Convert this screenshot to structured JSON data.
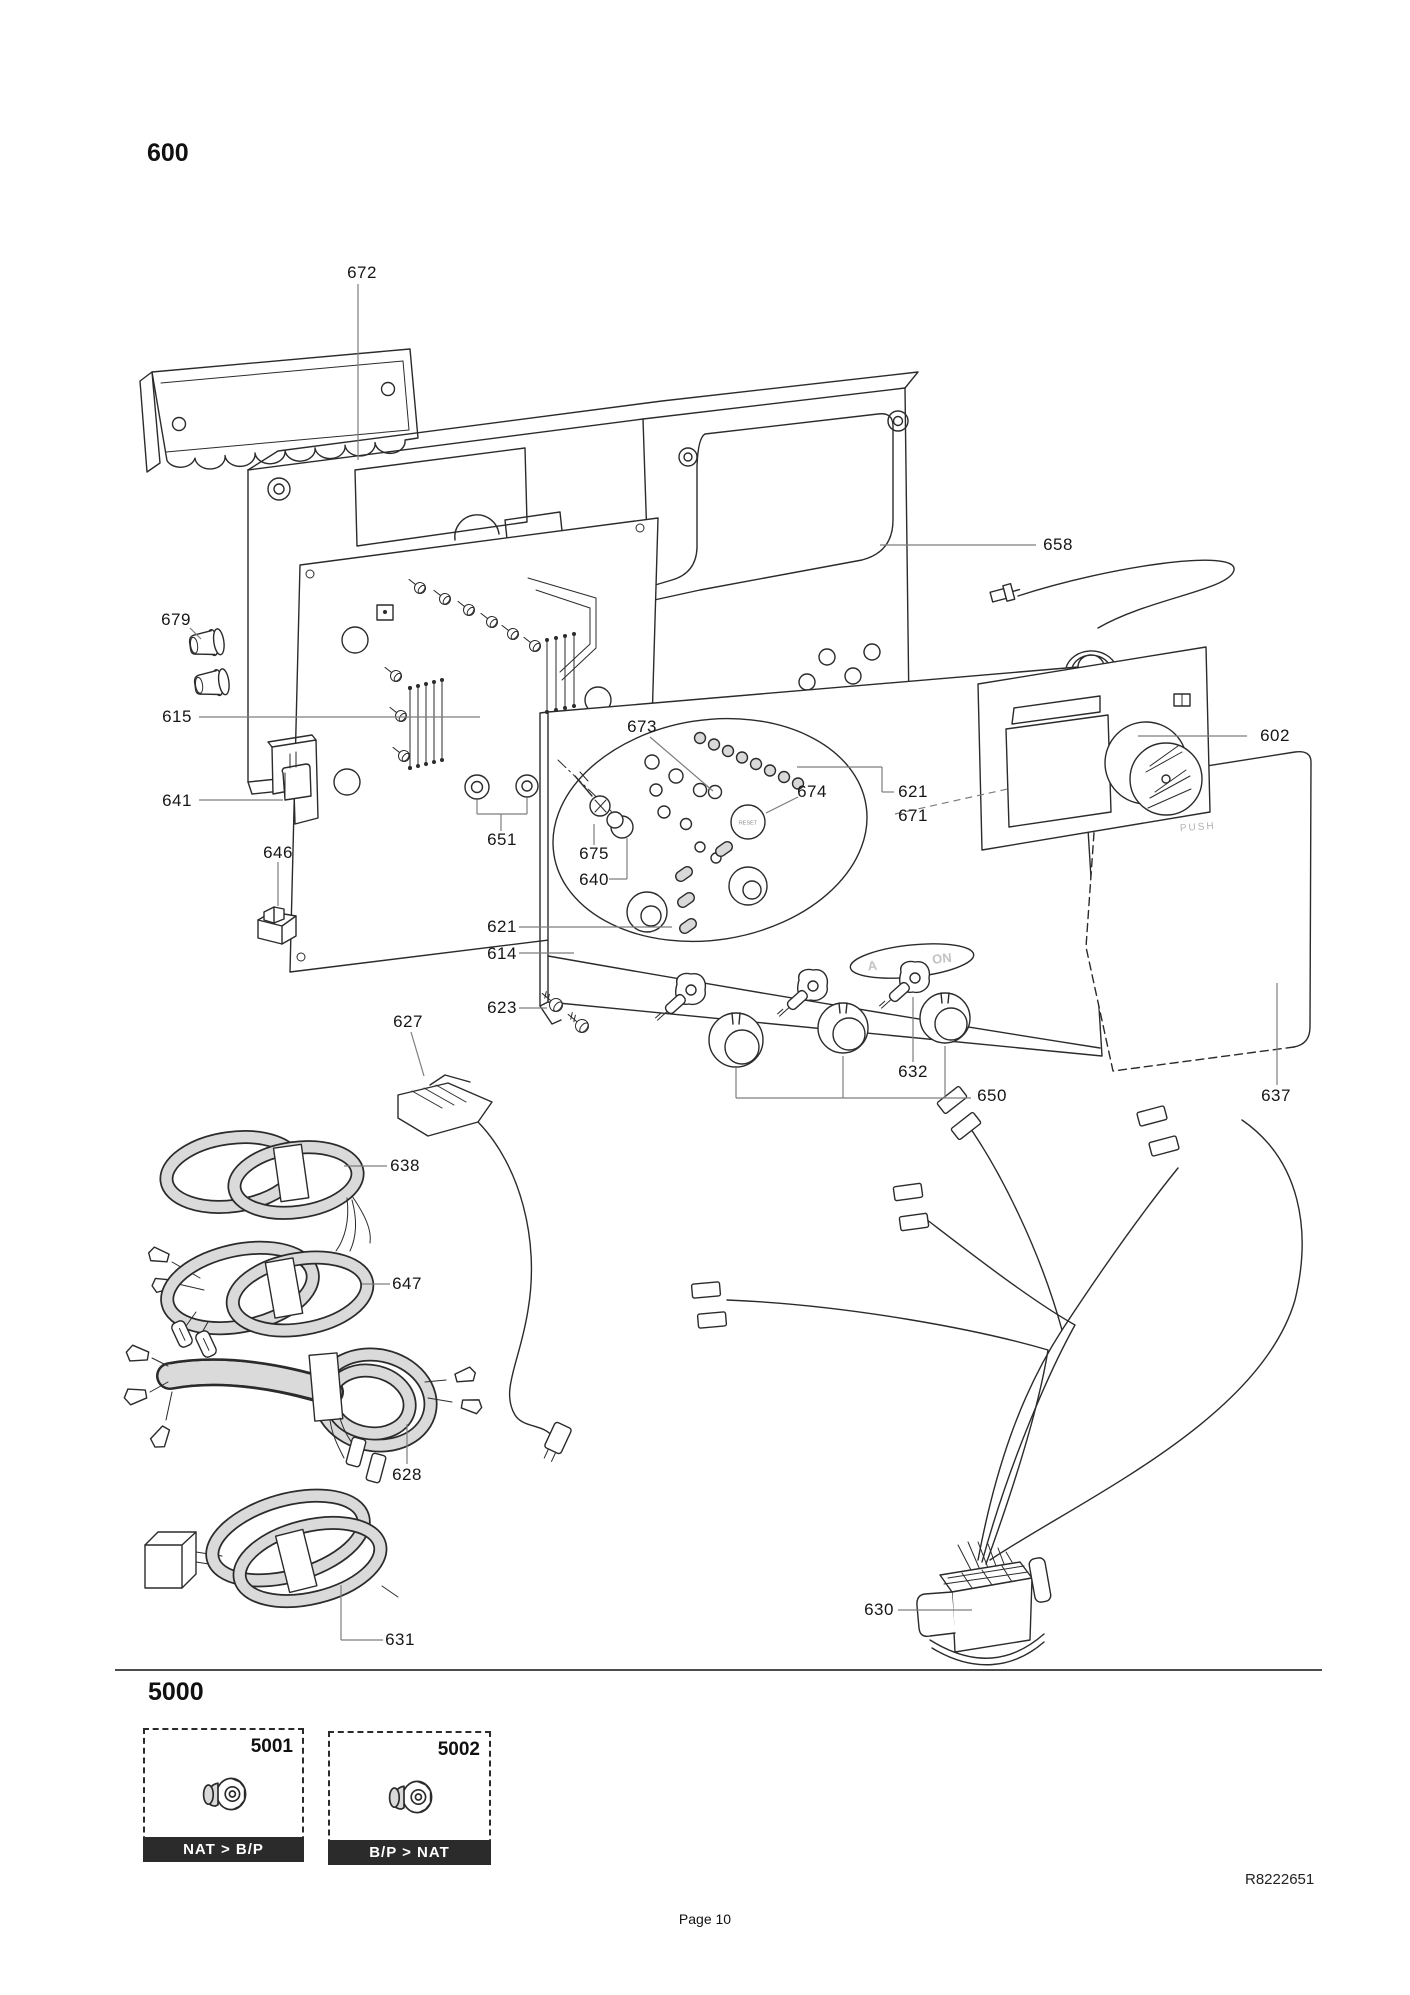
{
  "page": {
    "section1_title": "600",
    "section2_title": "5000",
    "doc_ref": "R8222651",
    "footer": "Page 10"
  },
  "panel": {
    "push_label": "PUSH",
    "reset_label": "RESET",
    "badge_left": "A",
    "badge_right": "ON"
  },
  "kits": [
    {
      "number": "5001",
      "conversion": "NAT > B/P"
    },
    {
      "number": "5002",
      "conversion": "B/P > NAT"
    }
  ],
  "colors": {
    "line": "#2b2b2b",
    "leader": "#7d7d7d",
    "cable_fill": "#dadada",
    "kit_bar_bg": "#2b2b2b",
    "kit_bar_text": "#ffffff"
  },
  "part_labels": [
    {
      "t": "672",
      "x": 362,
      "y": 273,
      "lead": [
        [
          358,
          284,
          358,
          460
        ]
      ]
    },
    {
      "t": "658",
      "x": 1058,
      "y": 545,
      "lead": [
        [
          880,
          545,
          1036,
          545
        ]
      ]
    },
    {
      "t": "679",
      "x": 176,
      "y": 620,
      "lead": [
        [
          190,
          628,
          201,
          639
        ]
      ]
    },
    {
      "t": "615",
      "x": 177,
      "y": 717,
      "lead": [
        [
          199,
          717,
          480,
          717
        ]
      ]
    },
    {
      "t": "602",
      "x": 1275,
      "y": 736,
      "lead": [
        [
          1138,
          736,
          1247,
          736
        ]
      ]
    },
    {
      "t": "673",
      "x": 642,
      "y": 727,
      "lead": [
        [
          650,
          737,
          713,
          791
        ]
      ]
    },
    {
      "t": "641",
      "x": 177,
      "y": 801,
      "lead": [
        [
          199,
          800,
          283,
          800
        ]
      ]
    },
    {
      "t": "674",
      "x": 812,
      "y": 792,
      "lead": [
        [
          798,
          797,
          766,
          813
        ]
      ]
    },
    {
      "t": "621",
      "x": 913,
      "y": 792,
      "lead": [
        [
          797,
          767,
          882,
          767
        ],
        [
          882,
          767,
          882,
          792
        ],
        [
          882,
          792,
          894,
          792
        ]
      ]
    },
    {
      "t": "671",
      "x": 913,
      "y": 816,
      "lead": [
        [
          895,
          814,
          1012,
          788,
          "d"
        ]
      ]
    },
    {
      "t": "646",
      "x": 278,
      "y": 853,
      "lead": [
        [
          278,
          862,
          278,
          906
        ]
      ]
    },
    {
      "t": "651",
      "x": 502,
      "y": 840,
      "lead": [
        [
          477,
          800,
          477,
          814
        ],
        [
          527,
          798,
          527,
          814
        ],
        [
          477,
          814,
          527,
          814
        ],
        [
          501,
          814,
          501,
          831
        ]
      ]
    },
    {
      "t": "675",
      "x": 594,
      "y": 854,
      "lead": [
        [
          594,
          824,
          594,
          845
        ]
      ]
    },
    {
      "t": "640",
      "x": 594,
      "y": 880,
      "lead": [
        [
          609,
          879,
          627,
          879
        ],
        [
          627,
          879,
          627,
          838
        ]
      ]
    },
    {
      "t": "621",
      "x": 502,
      "y": 927,
      "lead": [
        [
          519,
          927,
          672,
          927
        ]
      ]
    },
    {
      "t": "614",
      "x": 502,
      "y": 954,
      "lead": [
        [
          519,
          953,
          574,
          953
        ]
      ]
    },
    {
      "t": "623",
      "x": 502,
      "y": 1008,
      "lead": [
        [
          519,
          1008,
          547,
          1008
        ]
      ]
    },
    {
      "t": "627",
      "x": 408,
      "y": 1022,
      "lead": [
        [
          411,
          1032,
          424,
          1076
        ]
      ]
    },
    {
      "t": "632",
      "x": 913,
      "y": 1072,
      "lead": [
        [
          913,
          997,
          913,
          1062
        ]
      ]
    },
    {
      "t": "650",
      "x": 992,
      "y": 1096,
      "lead": [
        [
          736,
          1068,
          736,
          1098
        ],
        [
          843,
          1056,
          843,
          1098
        ],
        [
          945,
          1046,
          945,
          1098
        ],
        [
          736,
          1098,
          971,
          1098
        ]
      ]
    },
    {
      "t": "637",
      "x": 1276,
      "y": 1096,
      "lead": [
        [
          1277,
          983,
          1277,
          1085
        ]
      ]
    },
    {
      "t": "638",
      "x": 405,
      "y": 1166,
      "lead": [
        [
          344,
          1166,
          387,
          1166
        ]
      ]
    },
    {
      "t": "647",
      "x": 407,
      "y": 1284,
      "lead": [
        [
          362,
          1284,
          390,
          1284
        ]
      ]
    },
    {
      "t": "628",
      "x": 407,
      "y": 1475,
      "lead": [
        [
          407,
          1424,
          407,
          1464
        ]
      ]
    },
    {
      "t": "631",
      "x": 400,
      "y": 1640,
      "lead": [
        [
          341,
          1585,
          341,
          1640
        ],
        [
          341,
          1640,
          383,
          1640
        ]
      ]
    },
    {
      "t": "630",
      "x": 879,
      "y": 1610,
      "lead": [
        [
          898,
          1610,
          972,
          1610
        ]
      ]
    }
  ]
}
